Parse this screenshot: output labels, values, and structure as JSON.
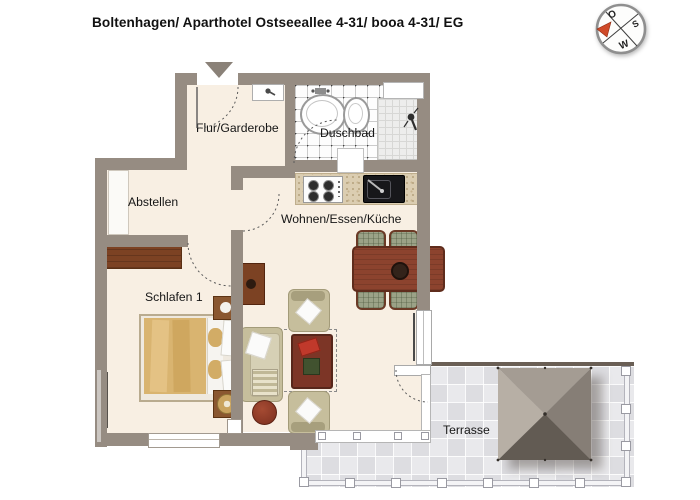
{
  "header": {
    "title": "Boltenhagen/ Aparthotel Ostseeallee 4-31/ booa 4-31/ EG"
  },
  "rooms": {
    "flur": {
      "label": "Flur/Garderobe"
    },
    "duschbad": {
      "label": "Duschbad"
    },
    "abstellen": {
      "label": "Abstellen"
    },
    "wohnen": {
      "label": "Wohnen/Essen/Küche"
    },
    "schlafen": {
      "label": "Schlafen 1"
    },
    "terrasse": {
      "label": "Terrasse"
    }
  },
  "compass": {
    "east": "O",
    "south": "S",
    "west": "W"
  },
  "colors": {
    "wall": "#968c82",
    "floor": "#f8efe3",
    "terraceTileA": "#e9e9ec",
    "terraceTileB": "#dddde1",
    "counter": "#dbcdb1",
    "wood": "#7c4223",
    "tableWood": "#8c432e",
    "upholstery": "#c6be9c",
    "blanket": "#d9b470",
    "accentRed": "#8e3a28",
    "umbrellaLight": "#b7afa5",
    "umbrellaDark": "#625b53"
  }
}
